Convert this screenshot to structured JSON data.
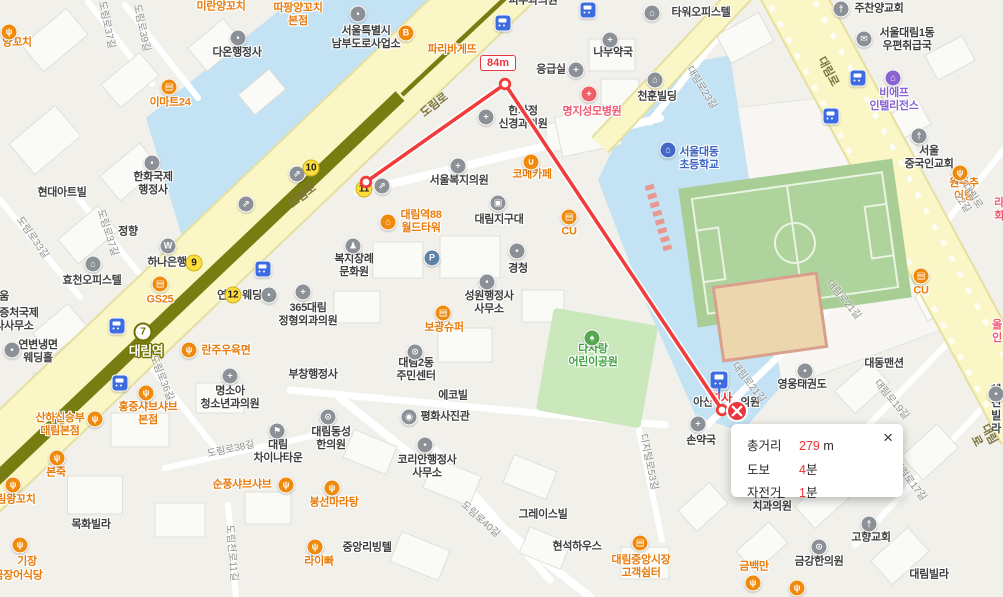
{
  "map": {
    "measurement": {
      "segment_distance": "84m",
      "path": [
        [
          366,
          182
        ],
        [
          505,
          84
        ],
        [
          722,
          410
        ]
      ],
      "popup": {
        "rows": [
          {
            "label": "총거리",
            "value": "279",
            "unit": " m"
          },
          {
            "label": "도보",
            "value": "4",
            "unit": "분"
          },
          {
            "label": "자전거",
            "value": "1",
            "unit": "분"
          }
        ],
        "close_glyph": "×"
      }
    },
    "station": {
      "line_badge": "7",
      "name": "대림역"
    },
    "exits": [
      {
        "n": "9",
        "x": 194,
        "y": 263
      },
      {
        "n": "10",
        "x": 311,
        "y": 168
      },
      {
        "n": "11",
        "x": 364,
        "y": 189
      },
      {
        "n": "12",
        "x": 233,
        "y": 295
      }
    ],
    "favorite": {
      "name": "회사",
      "x": 721,
      "y": 399,
      "icon_x": 719,
      "icon_y": 380
    },
    "bus_stops": [
      {
        "x": 503,
        "y": 23
      },
      {
        "x": 588,
        "y": 10
      },
      {
        "x": 858,
        "y": 78
      },
      {
        "x": 831,
        "y": 116
      },
      {
        "x": 117,
        "y": 326
      },
      {
        "x": 263,
        "y": 269
      },
      {
        "x": 120,
        "y": 383
      }
    ],
    "stray_icons": [
      {
        "g": "parking",
        "x": 432,
        "y": 258
      },
      {
        "g": "stairs",
        "x": 297,
        "y": 174
      },
      {
        "g": "stairs",
        "x": 382,
        "y": 186
      },
      {
        "g": "stairs",
        "x": 246,
        "y": 204
      },
      {
        "g": "restaurant",
        "x": 753,
        "y": 583
      },
      {
        "g": "restaurant",
        "x": 797,
        "y": 588
      }
    ],
    "labels": [
      {
        "t": "미란양꼬치",
        "x": 221,
        "y": 7,
        "c": "orange"
      },
      {
        "t": "따팡양꼬치\n본점",
        "x": 298,
        "y": 15,
        "c": "orange"
      },
      {
        "t": "양꼬치",
        "x": 17,
        "y": 43,
        "c": "orange",
        "icon": {
          "g": "restaurant",
          "x": 9,
          "y": 32
        }
      },
      {
        "t": "이마트24",
        "x": 170,
        "y": 103,
        "c": "orange",
        "icon": {
          "g": "store",
          "x": 169,
          "y": 87
        }
      },
      {
        "t": "다온행정사",
        "x": 237,
        "y": 53,
        "c": "gray",
        "icon": {
          "g": "admin",
          "x": 238,
          "y": 38
        }
      },
      {
        "t": "서울특별시\n남부도로사업소",
        "x": 366,
        "y": 38,
        "c": "gray",
        "icon": {
          "g": "admin",
          "x": 358,
          "y": 14
        }
      },
      {
        "t": "파리바게뜨",
        "x": 452,
        "y": 50,
        "c": "orange",
        "icon": {
          "g": "bakery",
          "x": 406,
          "y": 33
        }
      },
      {
        "t": "피부과의원",
        "x": 533,
        "y": 1,
        "c": "gray"
      },
      {
        "t": "타워오피스텔",
        "x": 701,
        "y": 13,
        "c": "gray",
        "icon": {
          "g": "building",
          "x": 652,
          "y": 13
        }
      },
      {
        "t": "주찬양교회",
        "x": 879,
        "y": 9,
        "c": "gray",
        "icon": {
          "g": "church",
          "x": 841,
          "y": 9
        }
      },
      {
        "t": "서울대림1동\n우편취급국",
        "x": 907,
        "y": 40,
        "c": "gray",
        "icon": {
          "g": "mail",
          "x": 864,
          "y": 39
        }
      },
      {
        "t": "나무약국",
        "x": 613,
        "y": 53,
        "c": "gray",
        "icon": {
          "g": "pharmacy",
          "x": 610,
          "y": 40
        }
      },
      {
        "t": "응급실",
        "x": 551,
        "y": 70,
        "c": "gray",
        "icon": {
          "g": "hospital",
          "x": 576,
          "y": 70
        }
      },
      {
        "t": "천훈빌딩",
        "x": 657,
        "y": 97,
        "c": "gray",
        "icon": {
          "g": "building",
          "x": 655,
          "y": 80
        }
      },
      {
        "t": "명지성모병원",
        "x": 592,
        "y": 112,
        "c": "red",
        "icon": {
          "g": "medical-red",
          "x": 589,
          "y": 94
        }
      },
      {
        "t": "한가정\n신경과의원",
        "x": 523,
        "y": 118,
        "c": "gray",
        "icon": {
          "g": "hospital",
          "x": 486,
          "y": 117
        }
      },
      {
        "t": "비에프\n인텔리전스",
        "x": 894,
        "y": 100,
        "c": "purple",
        "icon": {
          "g": "lodging",
          "x": 893,
          "y": 78
        }
      },
      {
        "t": "서울대동\n초등학교",
        "x": 699,
        "y": 159,
        "c": "blue",
        "icon": {
          "g": "school",
          "x": 668,
          "y": 150
        }
      },
      {
        "t": "서울\n중국인교회",
        "x": 929,
        "y": 158,
        "c": "gray",
        "icon": {
          "g": "church",
          "x": 919,
          "y": 136
        }
      },
      {
        "t": "원주추어탕",
        "x": 964,
        "y": 190,
        "c": "orange",
        "icon": {
          "g": "restaurant",
          "x": 960,
          "y": 173
        }
      },
      {
        "t": "라회",
        "x": 999,
        "y": 210,
        "c": "red"
      },
      {
        "t": "서울복지의원",
        "x": 459,
        "y": 181,
        "c": "gray",
        "icon": {
          "g": "hospital",
          "x": 458,
          "y": 166
        }
      },
      {
        "t": "코메카페",
        "x": 532,
        "y": 175,
        "c": "orange",
        "icon": {
          "g": "cafe",
          "x": 531,
          "y": 162
        }
      },
      {
        "t": "현대아트빌",
        "x": 62,
        "y": 193,
        "c": "gray"
      },
      {
        "t": "한화국제\n행정사",
        "x": 153,
        "y": 184,
        "c": "gray",
        "icon": {
          "g": "admin",
          "x": 152,
          "y": 163
        }
      },
      {
        "t": "정향",
        "x": 128,
        "y": 232,
        "c": "gray"
      },
      {
        "t": "하나은행",
        "x": 167,
        "y": 263,
        "c": "gray",
        "icon": {
          "g": "bank",
          "x": 168,
          "y": 246
        }
      },
      {
        "t": "효천오피스텔",
        "x": 92,
        "y": 281,
        "c": "gray",
        "icon": {
          "g": "building",
          "x": 93,
          "y": 264
        }
      },
      {
        "t": "GS25",
        "x": 160,
        "y": 300,
        "c": "orange",
        "icon": {
          "g": "store",
          "x": 160,
          "y": 284
        }
      },
      {
        "t": "움",
        "x": 4,
        "y": 297,
        "c": "gray"
      },
      {
        "t": "공증처국제\n사사무소",
        "x": 14,
        "y": 320,
        "c": "gray"
      },
      {
        "t": "연변냉면\n웨딩홀",
        "x": 38,
        "y": 352,
        "c": "gray",
        "icon": {
          "g": "dot",
          "x": 12,
          "y": 350
        }
      },
      {
        "t": "연",
        "x": 222,
        "y": 296,
        "c": "gray"
      },
      {
        "t": "웨딩",
        "x": 252,
        "y": 296,
        "c": "gray",
        "icon": {
          "g": "dot",
          "x": 269,
          "y": 295
        }
      },
      {
        "t": "란주우육면",
        "x": 226,
        "y": 351,
        "c": "orange",
        "icon": {
          "g": "restaurant",
          "x": 189,
          "y": 350
        }
      },
      {
        "t": "대림역88\n월드타워",
        "x": 421,
        "y": 222,
        "c": "orange",
        "icon": {
          "g": "building-o",
          "x": 388,
          "y": 222
        }
      },
      {
        "t": "대림지구대",
        "x": 499,
        "y": 220,
        "c": "gray",
        "icon": {
          "g": "police",
          "x": 498,
          "y": 203
        }
      },
      {
        "t": "CU",
        "x": 569,
        "y": 232,
        "c": "orange",
        "icon": {
          "g": "store",
          "x": 569,
          "y": 217
        }
      },
      {
        "t": "CU",
        "x": 921,
        "y": 291,
        "c": "orange",
        "icon": {
          "g": "store",
          "x": 921,
          "y": 276
        }
      },
      {
        "t": "경청",
        "x": 518,
        "y": 269,
        "c": "gray",
        "icon": {
          "g": "dot",
          "x": 517,
          "y": 251
        }
      },
      {
        "t": "복지장례\n문화원",
        "x": 354,
        "y": 266,
        "c": "gray",
        "icon": {
          "g": "person",
          "x": 353,
          "y": 246
        }
      },
      {
        "t": "성원행정사\n사무소",
        "x": 489,
        "y": 303,
        "c": "gray",
        "icon": {
          "g": "admin",
          "x": 487,
          "y": 282
        }
      },
      {
        "t": "365대림\n정형외과의원",
        "x": 308,
        "y": 315,
        "c": "gray",
        "icon": {
          "g": "hospital",
          "x": 303,
          "y": 292
        }
      },
      {
        "t": "보광슈퍼",
        "x": 444,
        "y": 328,
        "c": "orange",
        "icon": {
          "g": "market",
          "x": 443,
          "y": 313
        }
      },
      {
        "t": "다사랑\n어린이공원",
        "x": 593,
        "y": 356,
        "c": "green",
        "icon": {
          "g": "tree",
          "x": 592,
          "y": 338
        }
      },
      {
        "t": "대림2동\n주민센터",
        "x": 416,
        "y": 370,
        "c": "gray",
        "icon": {
          "g": "swirl",
          "x": 415,
          "y": 352
        }
      },
      {
        "t": "에코빌",
        "x": 453,
        "y": 396,
        "c": "gray"
      },
      {
        "t": "명소아\n청소년과의원",
        "x": 230,
        "y": 398,
        "c": "gray",
        "icon": {
          "g": "hospital",
          "x": 230,
          "y": 376
        }
      },
      {
        "t": "부창행정사",
        "x": 313,
        "y": 375,
        "c": "gray"
      },
      {
        "t": "대림\n차이나타운",
        "x": 278,
        "y": 452,
        "c": "gray",
        "icon": {
          "g": "flag",
          "x": 277,
          "y": 431
        }
      },
      {
        "t": "산하신승부\n대림본점",
        "x": 60,
        "y": 425,
        "c": "orange",
        "icon": {
          "g": "restaurant",
          "x": 95,
          "y": 419
        }
      },
      {
        "t": "홍중샤브샤브\n본점",
        "x": 148,
        "y": 414,
        "c": "orange",
        "icon": {
          "g": "restaurant",
          "x": 146,
          "y": 393
        }
      },
      {
        "t": "본죽",
        "x": 56,
        "y": 473,
        "c": "orange",
        "icon": {
          "g": "restaurant",
          "x": 57,
          "y": 458
        }
      },
      {
        "t": "대림왕꼬치",
        "x": 11,
        "y": 500,
        "c": "orange",
        "icon": {
          "g": "restaurant",
          "x": 13,
          "y": 485
        }
      },
      {
        "t": "목화빌라",
        "x": 91,
        "y": 525,
        "c": "gray"
      },
      {
        "t": "기장",
        "x": 27,
        "y": 562,
        "c": "orange",
        "icon": {
          "g": "restaurant",
          "x": 20,
          "y": 545
        }
      },
      {
        "t": "곰장어식당",
        "x": 18,
        "y": 576,
        "c": "orange"
      },
      {
        "t": "순풍샤브샤브",
        "x": 242,
        "y": 485,
        "c": "orange",
        "icon": {
          "g": "restaurant",
          "x": 286,
          "y": 485
        }
      },
      {
        "t": "봉선마라탕",
        "x": 334,
        "y": 503,
        "c": "orange",
        "icon": {
          "g": "restaurant",
          "x": 332,
          "y": 488
        }
      },
      {
        "t": "라이빠",
        "x": 319,
        "y": 562,
        "c": "orange",
        "icon": {
          "g": "restaurant",
          "x": 315,
          "y": 547
        }
      },
      {
        "t": "중앙리빙텔",
        "x": 367,
        "y": 548,
        "c": "gray"
      },
      {
        "t": "대림동성\n한의원",
        "x": 331,
        "y": 439,
        "c": "gray",
        "icon": {
          "g": "swirl",
          "x": 328,
          "y": 417
        }
      },
      {
        "t": "평화사진관",
        "x": 445,
        "y": 417,
        "c": "gray",
        "icon": {
          "g": "camera",
          "x": 409,
          "y": 417
        }
      },
      {
        "t": "코리안행정사\n사무소",
        "x": 427,
        "y": 467,
        "c": "gray",
        "icon": {
          "g": "admin",
          "x": 425,
          "y": 445
        }
      },
      {
        "t": "그레이스빌",
        "x": 543,
        "y": 515,
        "c": "gray"
      },
      {
        "t": "현석하우스",
        "x": 577,
        "y": 547,
        "c": "gray"
      },
      {
        "t": "대림중앙시장\n고객쉼터",
        "x": 641,
        "y": 567,
        "c": "orange",
        "icon": {
          "g": "market",
          "x": 640,
          "y": 543
        }
      },
      {
        "t": "우리들",
        "x": 771,
        "y": 494,
        "c": "gray"
      },
      {
        "t": "치과의원",
        "x": 772,
        "y": 507,
        "c": "gray"
      },
      {
        "t": "손약국",
        "x": 701,
        "y": 441,
        "c": "gray",
        "icon": {
          "g": "pharmacy",
          "x": 698,
          "y": 424
        }
      },
      {
        "t": "아산",
        "x": 703,
        "y": 403,
        "c": "gray"
      },
      {
        "t": "의원",
        "x": 750,
        "y": 403,
        "c": "gray"
      },
      {
        "t": "영웅태권도",
        "x": 802,
        "y": 385,
        "c": "gray",
        "icon": {
          "g": "dot",
          "x": 805,
          "y": 371
        }
      },
      {
        "t": "대동맨션",
        "x": 884,
        "y": 364,
        "c": "gray"
      },
      {
        "t": "고향교회",
        "x": 871,
        "y": 538,
        "c": "gray",
        "icon": {
          "g": "church",
          "x": 869,
          "y": 524
        }
      },
      {
        "t": "금백만",
        "x": 754,
        "y": 567,
        "c": "orange"
      },
      {
        "t": "금강한의원",
        "x": 819,
        "y": 562,
        "c": "gray",
        "icon": {
          "g": "swirl",
          "x": 819,
          "y": 547
        }
      },
      {
        "t": "대림빌라",
        "x": 929,
        "y": 575,
        "c": "gray"
      },
      {
        "t": "혜진빌라",
        "x": 996,
        "y": 410,
        "c": "gray",
        "icon": {
          "g": "dot",
          "x": 996,
          "y": 394
        }
      },
      {
        "t": "올인",
        "x": 997,
        "y": 332,
        "c": "red"
      },
      {
        "t": "도림로37길",
        "x": 106,
        "y": 25,
        "c": "street",
        "r": 78
      },
      {
        "t": "도림로39길",
        "x": 141,
        "y": 28,
        "c": "street",
        "r": 78
      },
      {
        "t": "도림로33길",
        "x": 32,
        "y": 238,
        "c": "street",
        "r": 55
      },
      {
        "t": "도림로37길",
        "x": 107,
        "y": 233,
        "c": "street",
        "r": 72
      },
      {
        "t": "도림로36길",
        "x": 161,
        "y": 378,
        "c": "street",
        "r": 68
      },
      {
        "t": "도림로38길",
        "x": 231,
        "y": 450,
        "c": "street",
        "r": -12
      },
      {
        "t": "도림천로11길",
        "x": 231,
        "y": 553,
        "c": "street",
        "r": 85
      },
      {
        "t": "도림로40길",
        "x": 480,
        "y": 520,
        "c": "street",
        "r": 42
      },
      {
        "t": "디지털로53길",
        "x": 648,
        "y": 462,
        "c": "street",
        "r": 78
      },
      {
        "t": "대림로23길",
        "x": 701,
        "y": 88,
        "c": "street",
        "r": 58
      },
      {
        "t": "대림로22길",
        "x": 967,
        "y": 200,
        "c": "street",
        "r": 55
      },
      {
        "t": "대림로21길",
        "x": 843,
        "y": 300,
        "c": "street",
        "r": 50
      },
      {
        "t": "대림로21길",
        "x": 748,
        "y": 383,
        "c": "street",
        "r": 52
      },
      {
        "t": "대림로19길",
        "x": 891,
        "y": 400,
        "c": "street",
        "r": 50
      },
      {
        "t": "대림로17길",
        "x": 909,
        "y": 481,
        "c": "street",
        "r": 52
      },
      {
        "t": "도림로",
        "x": 435,
        "y": 106,
        "c": "roadname",
        "r": -38
      },
      {
        "t": "도림로",
        "x": 303,
        "y": 197,
        "c": "roadname",
        "r": -38
      },
      {
        "t": "대림로",
        "x": 827,
        "y": 72,
        "c": "roadname",
        "r": 62
      },
      {
        "t": "대림로",
        "x": 982,
        "y": 438,
        "c": "roadname",
        "r": 62
      }
    ]
  }
}
